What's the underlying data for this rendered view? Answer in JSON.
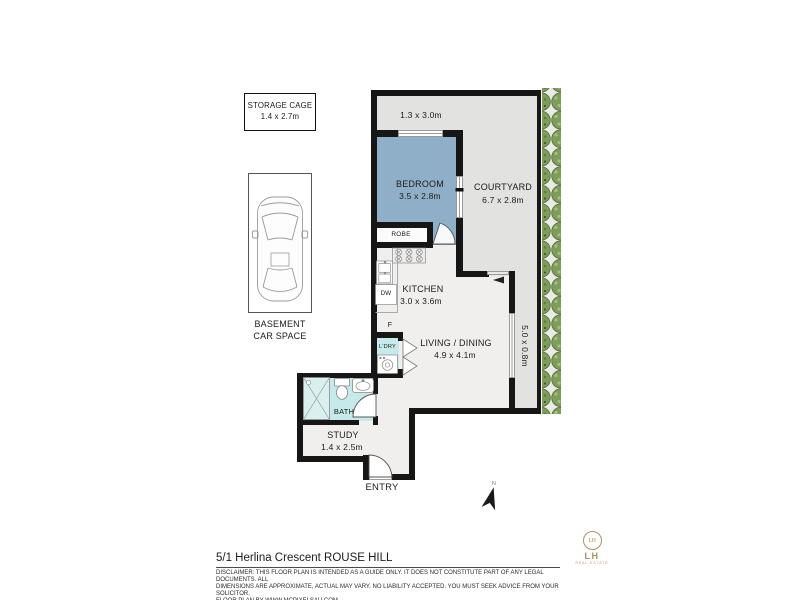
{
  "address": "5/1 Herlina Crescent ROUSE HILL",
  "disclaimer": {
    "line1": "DISCLAIMER: THIS FLOOR PLAN IS INTENDED AS A GUIDE ONLY.  IT DOES NOT CONSTITUTE PART OF ANY LEGAL DOCUMENTS.  ALL",
    "line2": "DIMENSIONS ARE APPROXIMATE, ACTUAL MAY VARY.  NO LIABILITY ACCEPTED. YOU MUST SEEK ADVICE FROM YOUR SOLICITOR.",
    "line3": "FLOOR PLAN BY WWW.MCPIXELSAU.COM"
  },
  "storage_cage": {
    "name": "STORAGE CAGE",
    "dims": "1.4 x 2.7m"
  },
  "car_space": {
    "line1": "BASEMENT",
    "line2": "CAR SPACE"
  },
  "rooms": {
    "bedroom": {
      "name": "BEDROOM",
      "dims": "3.5 x 2.8m"
    },
    "courtyard": {
      "name": "COURTYARD",
      "dims": "6.7 x 2.8m"
    },
    "kitchen": {
      "name": "KITCHEN",
      "dims": "3.0 x 3.6m"
    },
    "living": {
      "name": "LIVING / DINING",
      "dims": "4.9 x 4.1m"
    },
    "study": {
      "name": "STUDY",
      "dims": "1.4 x 2.5m"
    },
    "bath": {
      "name": "BATH"
    },
    "robe": {
      "name": "ROBE"
    },
    "laundry": {
      "name": "L'DRY"
    },
    "entry": {
      "name": "ENTRY"
    }
  },
  "annotations": {
    "top_area_dims": "1.3 x 3.0m",
    "side_area_dims": "5.0 x 0.8m",
    "fridge": "F",
    "dishwasher": "DW",
    "north": "N"
  },
  "logo": {
    "monogram": "LH",
    "name": "LH",
    "tagline": "REAL ESTATE"
  },
  "colors": {
    "bedroom_fill": "#8fafc9",
    "wet_area_fill": "#c5eae9",
    "courtyard_fill": "#e2e2e1",
    "interior_fill": "#f0efee",
    "wall": "#161616",
    "hedge_green": "#7e9d59",
    "logo_gold": "#ab9164"
  }
}
